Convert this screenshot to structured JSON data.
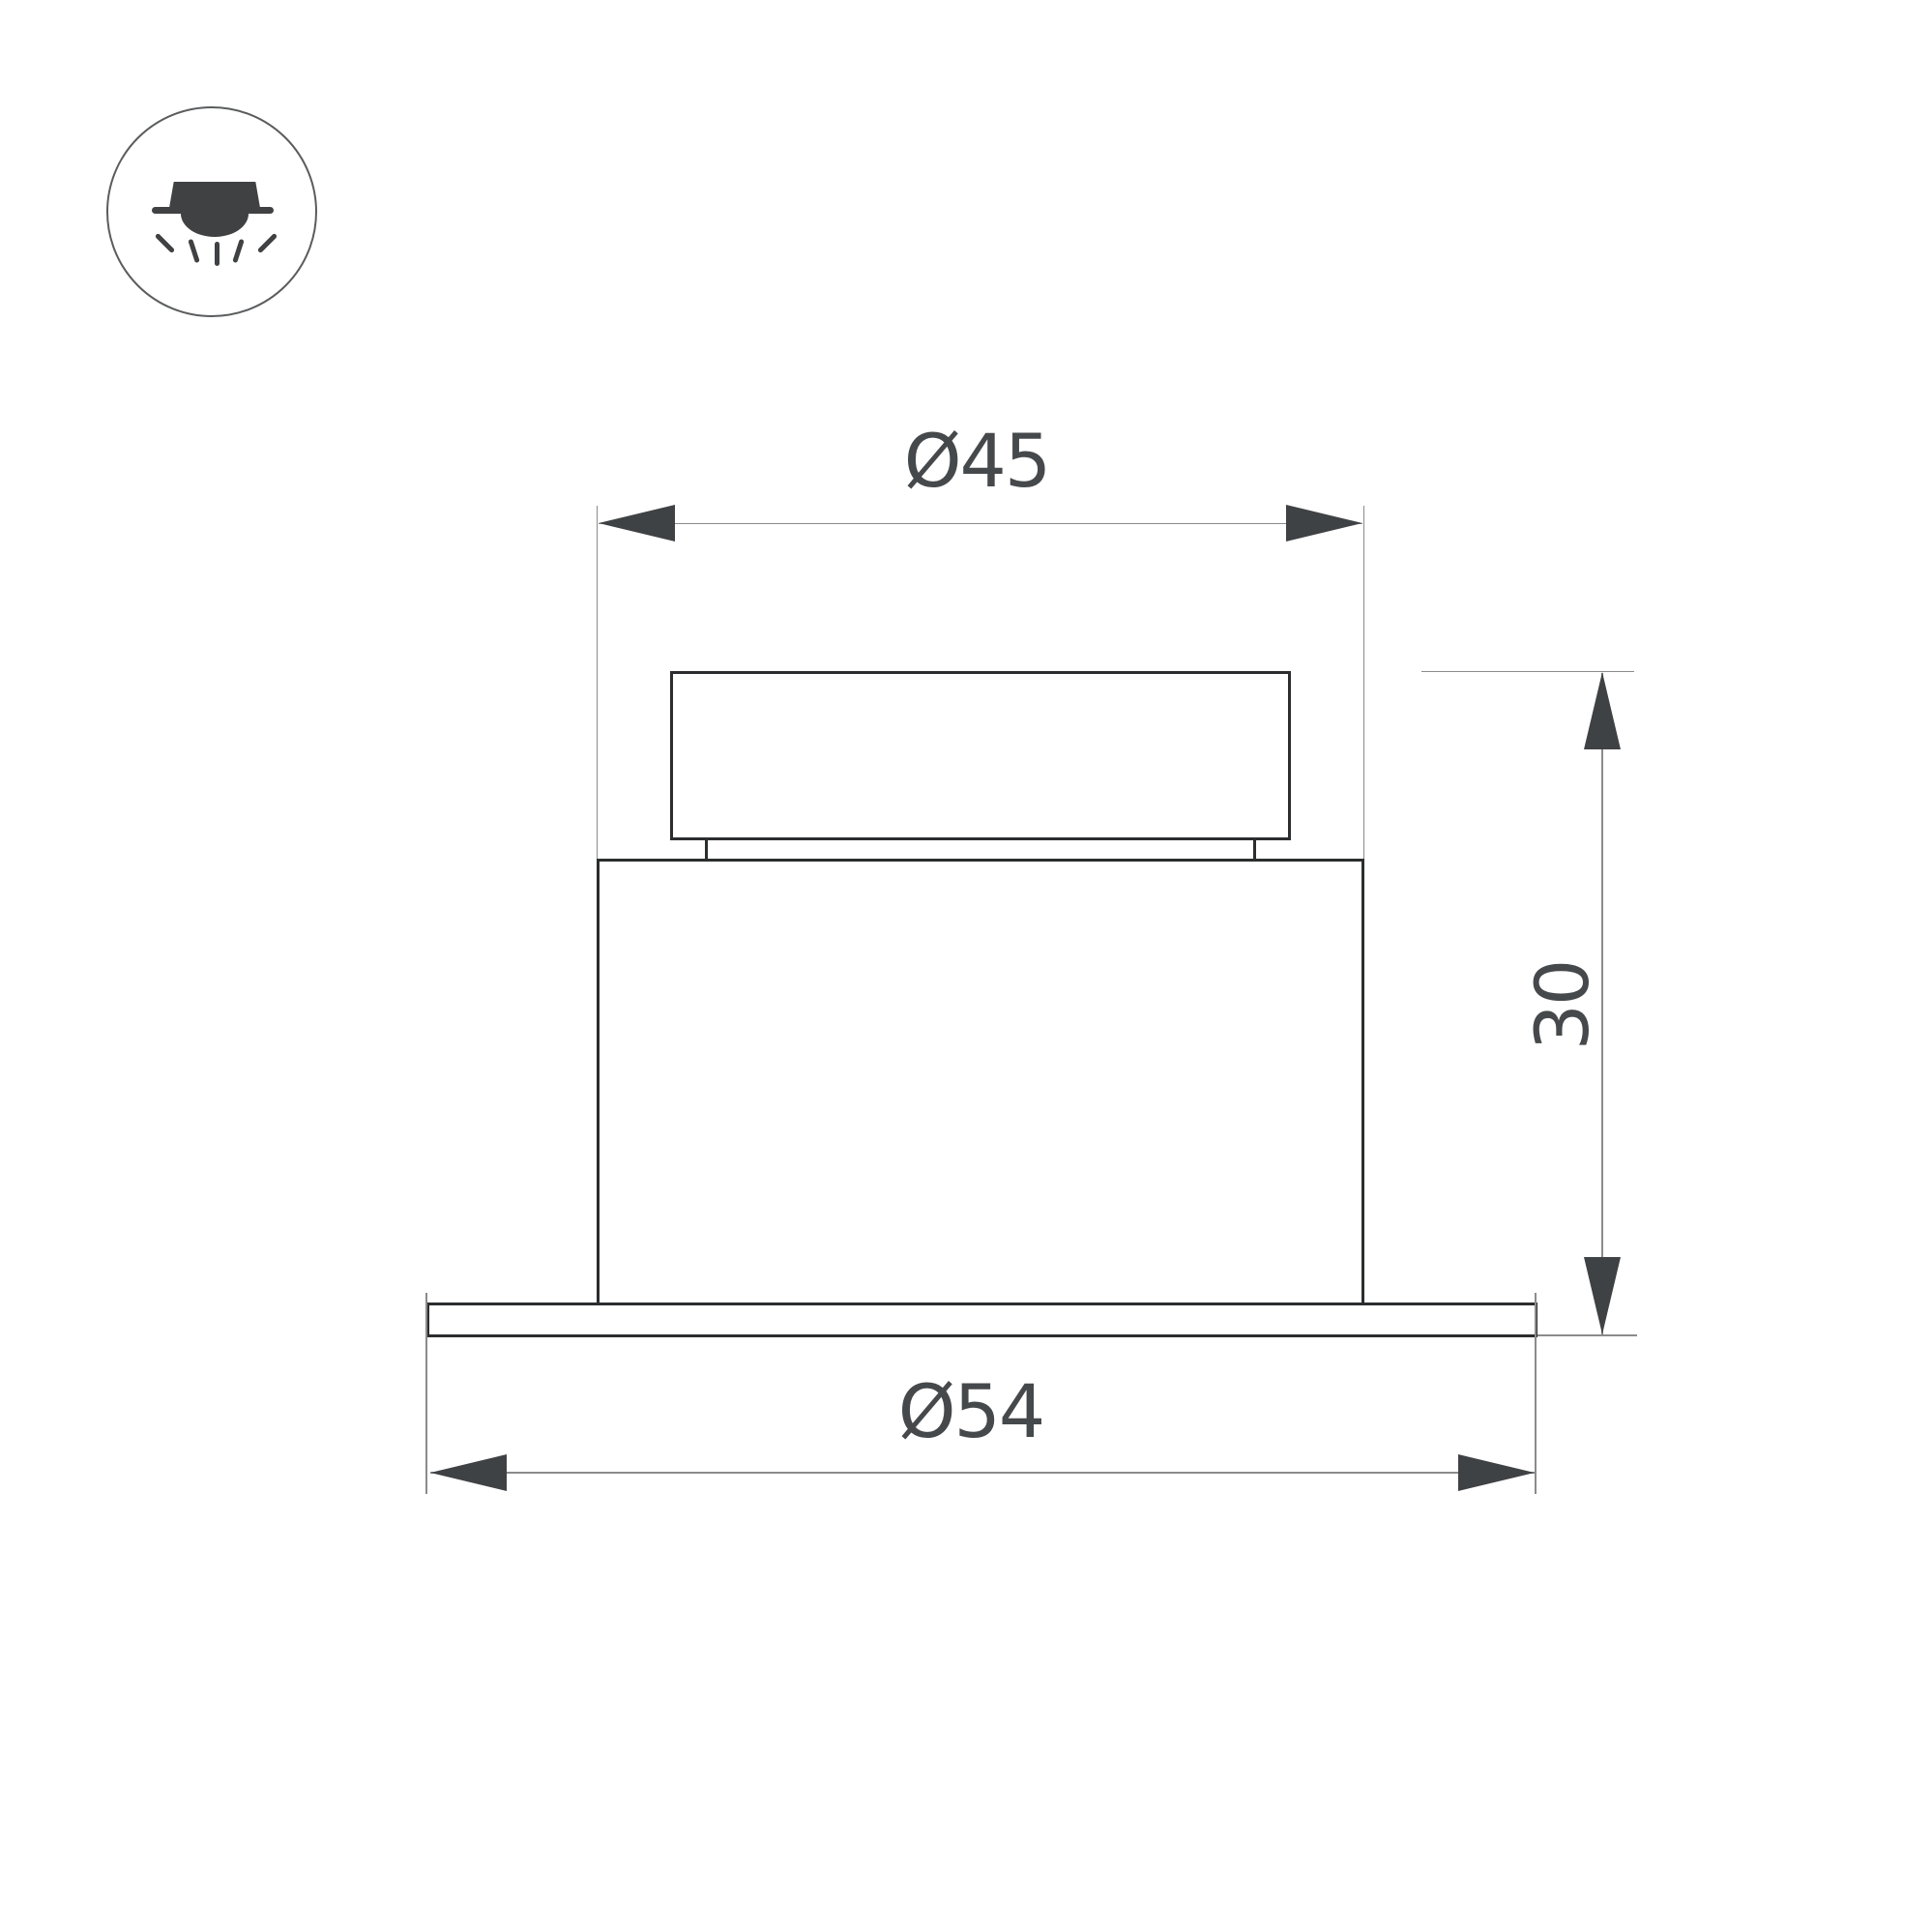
{
  "page": {
    "background_color": "#ffffff",
    "type": "technical dimension drawing of a recessed downlight fixture"
  },
  "icon": {
    "name": "recessed-downlight-icon",
    "glyph_color": "#3f4143",
    "circle_color": "#5a5c5e"
  },
  "drawing": {
    "outline_color": "#2b2d2e",
    "dim_line_color": "#8b8b8b",
    "arrow_color": "#3f4244",
    "label_color": "#46494b",
    "dimensions": {
      "diameter_top": {
        "label": "Ø45",
        "orientation": "horizontal",
        "measures": "body diameter"
      },
      "diameter_flange": {
        "label": "Ø54",
        "orientation": "horizontal",
        "measures": "flange diameter"
      },
      "height": {
        "label": "30",
        "orientation": "vertical",
        "measures": "fixture height"
      }
    }
  }
}
